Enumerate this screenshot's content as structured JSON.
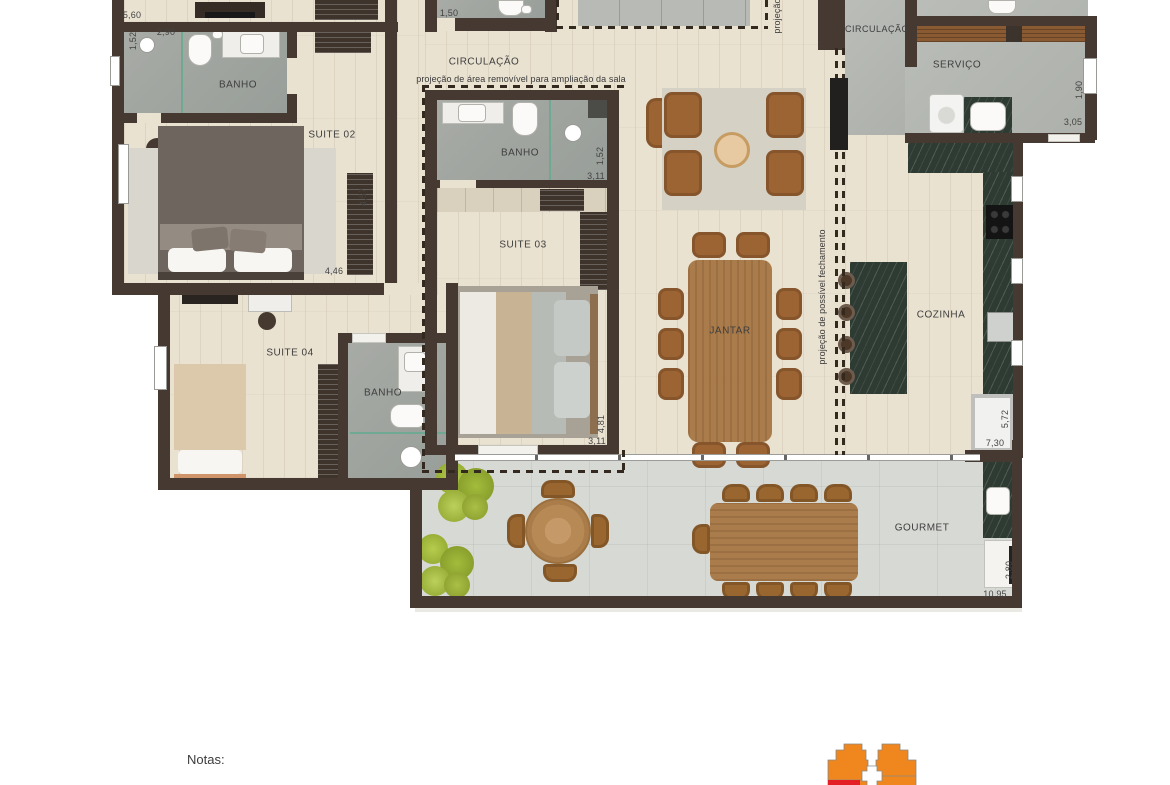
{
  "rooms": [
    "BANHO",
    "SUITE 02",
    "CIRCULAÇÃO",
    "BANHO",
    "SUITE 03",
    "SUITE 04",
    "BANHO",
    "JANTAR",
    "CIRCULAÇÃO",
    "SERVIÇO",
    "COZINHA",
    "GOURMET"
  ],
  "dims": [
    "5,60",
    "1,52",
    "2,90",
    "4,57",
    "4,46",
    "1,50",
    "1,52",
    "3,11",
    "4,81",
    "3,11",
    "1,90",
    "3,05",
    "5,72",
    "7,30",
    "2,80",
    "10,95"
  ],
  "notes": [
    "projeção de área removível para ampliação da sala",
    "projeção de possível fechamento",
    "projeção"
  ],
  "footer": {
    "notes_label": "Notas:"
  },
  "colors": {
    "wall": "#463931",
    "wood": "#eae2d1",
    "bath": "#a2a6a1",
    "service": "#b6b9b4",
    "concrete": "#d7d9d4",
    "marble": "#2e3b33",
    "counter_wood": "#8a5a33",
    "furniture_wood": "#ab7c4b",
    "leather": "#9c6433",
    "glass": "#6fa893",
    "keyplan_orange": "#f0861e",
    "keyplan_red": "#e41e25"
  }
}
